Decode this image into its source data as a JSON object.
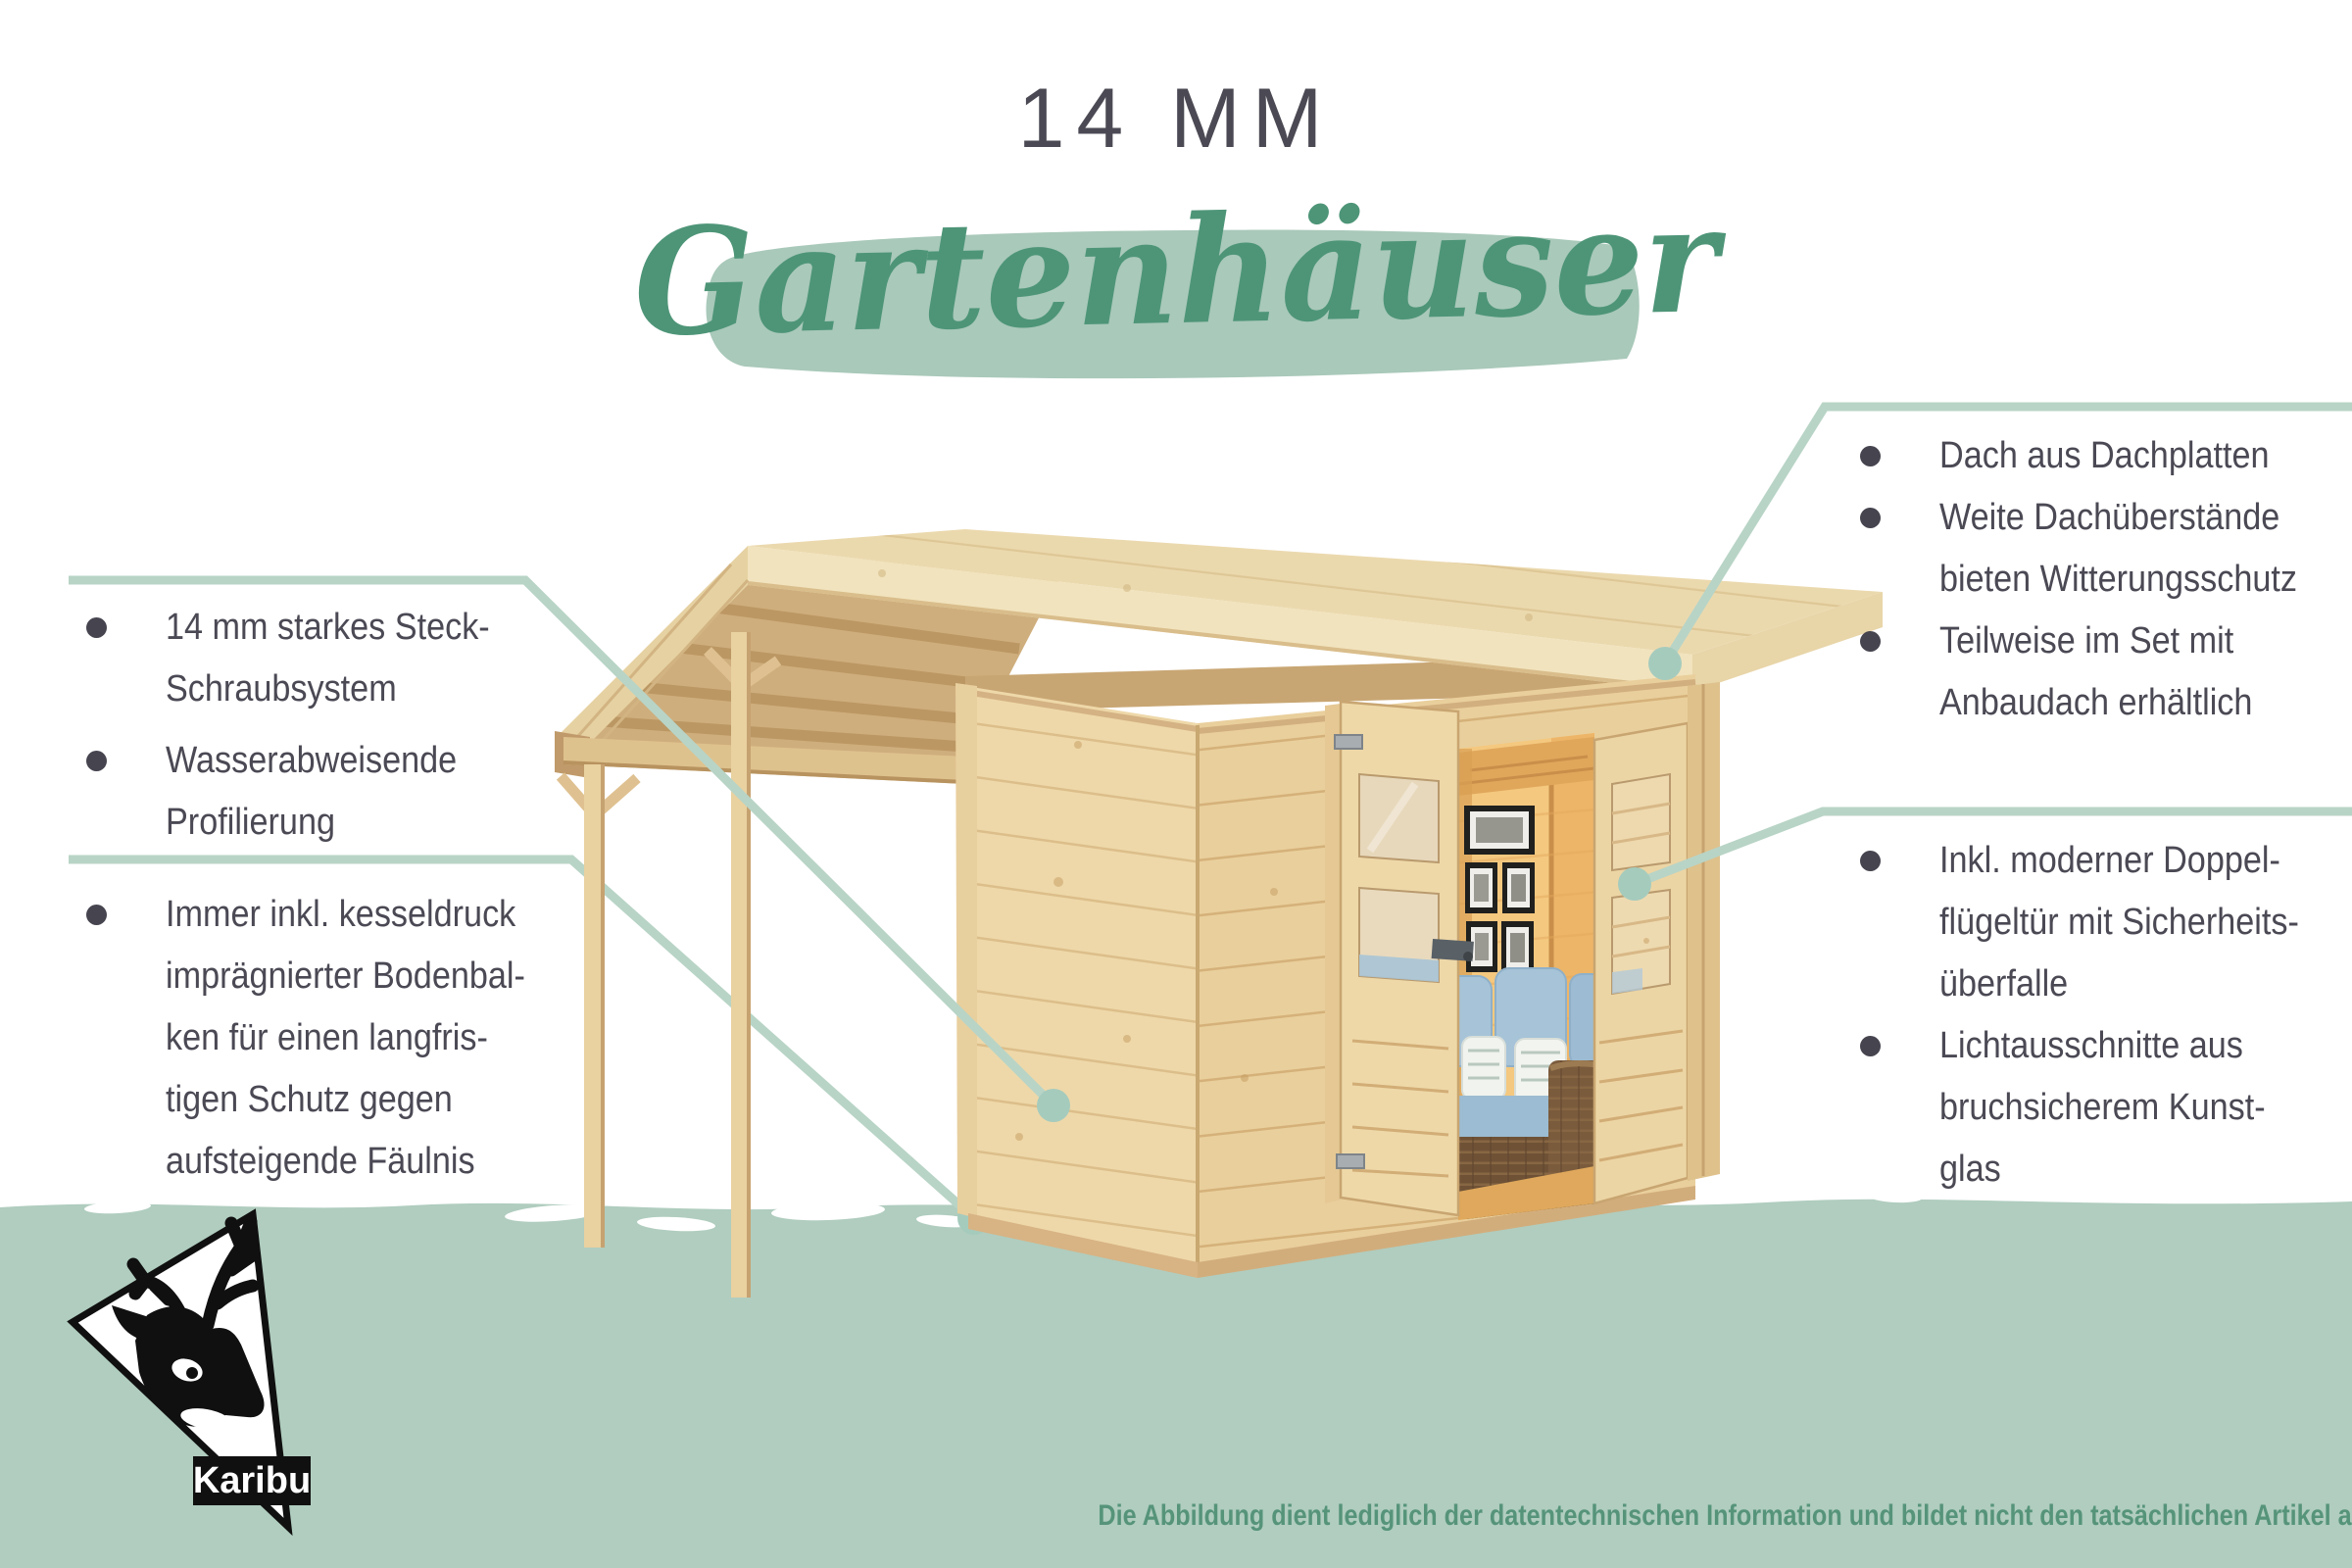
{
  "title": "14 MM",
  "subtitle": "Gartenhäuser",
  "left_features": [
    {
      "lines": [
        "14 mm starkes Steck-",
        "Schraubsystem"
      ]
    },
    {
      "lines": [
        "Wasserabweisende",
        "Profilierung"
      ]
    },
    {
      "lines": [
        "Immer inkl. kesseldruck",
        "imprägnierter Bodenbal-",
        "ken für einen langfris-",
        "tigen Schutz gegen",
        "aufsteigende Fäulnis"
      ]
    }
  ],
  "right_features": [
    {
      "lines": [
        "Dach aus Dachplatten"
      ]
    },
    {
      "lines": [
        "Weite Dachüberstände",
        "bieten Witterungsschutz"
      ]
    },
    {
      "lines": [
        "Teilweise im Set mit",
        "Anbaudach erhältlich"
      ]
    },
    {
      "lines": [
        "Inkl. moderner Doppel-",
        "flügeltür mit Sicherheits-",
        "überfalle"
      ]
    },
    {
      "lines": [
        "Lichtausschnitte aus",
        "bruchsicherem Kunst-",
        "glas"
      ]
    }
  ],
  "brand": {
    "logo_text": "Karibu",
    "icon": "karibu-deer-head-icon"
  },
  "disclaimer": "Die Abbildung dient lediglich der datentechnischen Information und bildet nicht den tatsächlichen Artikel ab.",
  "colors": {
    "text_dark": "#4a4954",
    "script_green": "#4e9578",
    "brush_green": "#a9c9ba",
    "band_green": "#b0cdbf",
    "callout_line": "#b8d4c6",
    "callout_dot": "#a5cbbd",
    "disclaimer_green": "#56947a"
  }
}
